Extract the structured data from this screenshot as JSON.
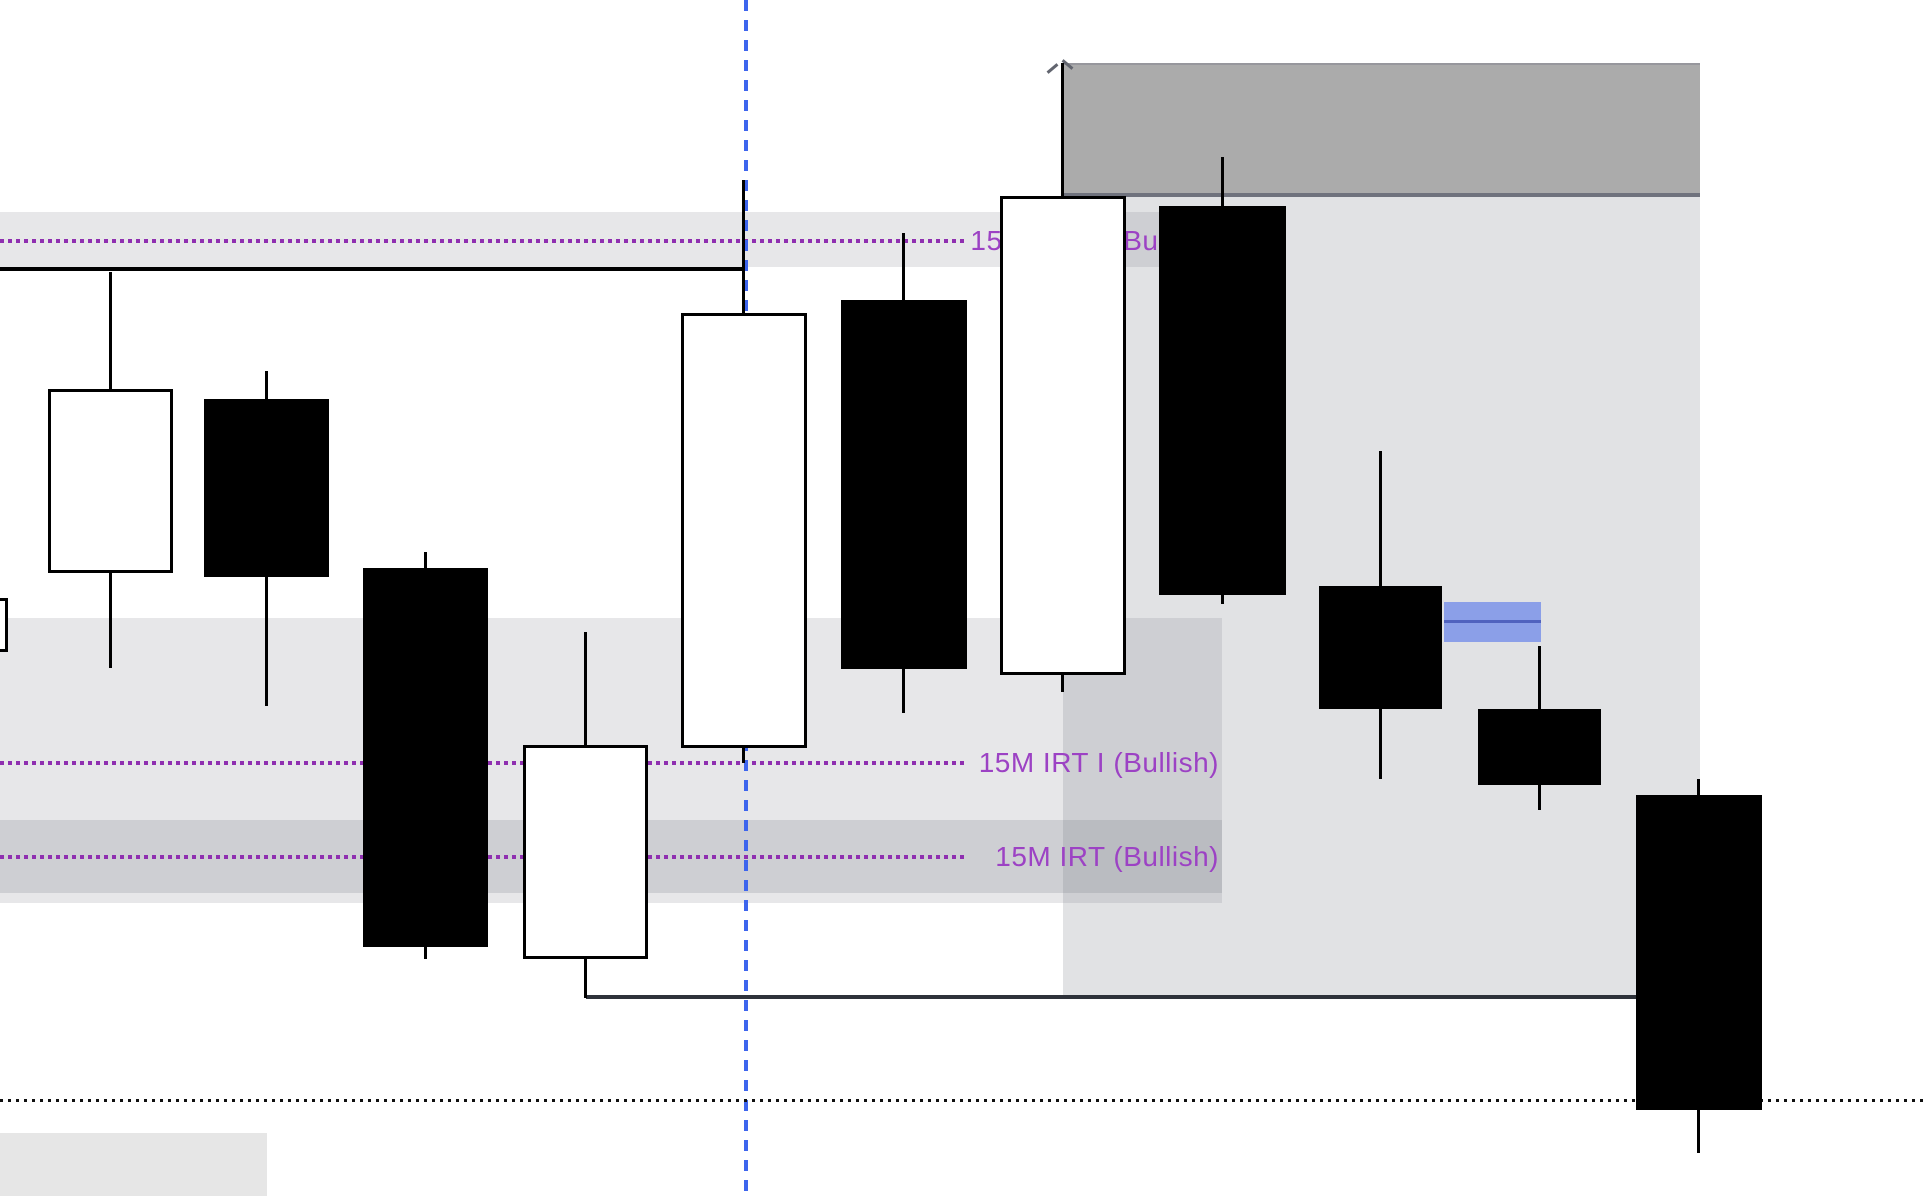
{
  "app": {
    "description": "Zoomed candlestick trading chart with IRT (Bullish) indicator levels, supply/demand zones and drawing objects"
  },
  "labels": {
    "top": {
      "text": "15M IRT II (Bullish)"
    },
    "middle": {
      "text": "15M IRT I (Bullish)"
    },
    "bottom": {
      "text": "15M IRT (Bullish)"
    }
  },
  "colors": {
    "background": "#FFFFFF",
    "purple_text": "#9C42C4",
    "purple_dots": "#8F2FB0",
    "blue_dash": "#3D65ED",
    "badge_fill": "#8B9FE8",
    "badge_line": "#5062BE",
    "band_fill": "rgba(120,123,134,0.18)",
    "sub_band_fill": "rgba(120,123,134,0.22)",
    "zone_fill": "rgba(120,123,134,0.22)",
    "header_fill": "#ABABAB",
    "header_border_bottom": "#6F727D",
    "header_border_top": "#97979D",
    "candle_up_fill": "#FFFFFF",
    "candle_down_fill": "#000000",
    "candle_border": "#000000",
    "low_line": "#2E323A",
    "black_line": "#000000",
    "bottom_dots": "#101010",
    "handle": "#62656F",
    "bottom_left_box": "#E6E6E6"
  },
  "chart_data": {
    "type": "candlestick",
    "axes_visible": false,
    "units": "screen pixels, y increases downward; no price/time tick labels are visible in the screenshot",
    "candles": [
      {
        "i": 0,
        "x": -14,
        "w": 22,
        "high": 598,
        "body_top": 598,
        "body_bottom": 652,
        "low": 652,
        "dir": "up",
        "partial": true
      },
      {
        "i": 1,
        "x": 48,
        "w": 125,
        "high": 272,
        "body_top": 389,
        "body_bottom": 573,
        "low": 668,
        "dir": "up"
      },
      {
        "i": 2,
        "x": 204,
        "w": 125,
        "high": 371,
        "body_top": 399,
        "body_bottom": 577,
        "low": 706,
        "dir": "down"
      },
      {
        "i": 3,
        "x": 363,
        "w": 125,
        "high": 552,
        "body_top": 568,
        "body_bottom": 947,
        "low": 959,
        "dir": "down"
      },
      {
        "i": 4,
        "x": 523,
        "w": 125,
        "high": 632,
        "body_top": 745,
        "body_bottom": 959,
        "low": 998,
        "dir": "up"
      },
      {
        "i": 5,
        "x": 681,
        "w": 126,
        "high": 180,
        "body_top": 313,
        "body_bottom": 748,
        "low": 763,
        "dir": "up"
      },
      {
        "i": 6,
        "x": 841,
        "w": 126,
        "high": 233,
        "body_top": 300,
        "body_bottom": 669,
        "low": 713,
        "dir": "down"
      },
      {
        "i": 7,
        "x": 1000,
        "w": 126,
        "high": 63,
        "body_top": 196,
        "body_bottom": 675,
        "low": 692,
        "dir": "up"
      },
      {
        "i": 8,
        "x": 1159,
        "w": 127,
        "high": 157,
        "body_top": 206,
        "body_bottom": 595,
        "low": 604,
        "dir": "down"
      },
      {
        "i": 9,
        "x": 1319,
        "w": 123,
        "high": 451,
        "body_top": 586,
        "body_bottom": 709,
        "low": 779,
        "dir": "down"
      },
      {
        "i": 10,
        "x": 1478,
        "w": 123,
        "high": 646,
        "body_top": 709,
        "body_bottom": 785,
        "low": 810,
        "dir": "down"
      },
      {
        "i": 11,
        "x": 1636,
        "w": 126,
        "high": 779,
        "body_top": 795,
        "body_bottom": 1110,
        "low": 1153,
        "dir": "down"
      }
    ],
    "annotations": {
      "purple_dotted_levels": [
        {
          "y": 241,
          "x_end": 965,
          "label": "15M IRT II (Bullish)"
        },
        {
          "y": 763,
          "x_end": 965,
          "label": "15M IRT I (Bullish)"
        },
        {
          "y": 857,
          "x_end": 965,
          "label": "15M IRT (Bullish)"
        }
      ],
      "bands": [
        {
          "name": "irt-ii-band",
          "x": 0,
          "y": 212,
          "w": 1222,
          "h": 55,
          "shade": "light"
        },
        {
          "name": "irt-i-band",
          "x": 0,
          "y": 618,
          "w": 1222,
          "h": 285,
          "shade": "light"
        },
        {
          "name": "irt-band",
          "x": 0,
          "y": 820,
          "w": 1222,
          "h": 73,
          "shade": "dark"
        }
      ],
      "zones": [
        {
          "name": "supply-header-box",
          "x": 1063,
          "y": 63,
          "w": 637,
          "h": 134,
          "style": "solid-gray"
        },
        {
          "name": "right-demand-zone",
          "x": 1063,
          "y": 196,
          "w": 637,
          "h": 801,
          "style": "translucent"
        },
        {
          "name": "bottom-left-box",
          "x": 0,
          "y": 1133,
          "w": 267,
          "h": 63,
          "style": "solid-light"
        }
      ],
      "black_lines": [
        {
          "name": "upper-structure-line",
          "x1": 0,
          "x2": 745,
          "y": 267,
          "h": 4,
          "style": "solid"
        },
        {
          "name": "low-structure-line",
          "x1": 586,
          "x2": 1690,
          "y": 995,
          "h": 4,
          "style": "solid"
        },
        {
          "name": "bottom-dotted-line",
          "x1": 0,
          "x2": 1924,
          "y": 1099,
          "h": 3,
          "style": "dotted"
        }
      ],
      "vertical_dashed_line": {
        "x": 744,
        "w": 4,
        "y1": 0,
        "y2": 1196
      },
      "order_block_badge": {
        "x": 1444,
        "y": 602,
        "w": 97,
        "h": 40,
        "mid_line_y": 620
      },
      "handle_marks": [
        {
          "x": 1046,
          "y": 67,
          "angle": -40
        },
        {
          "x": 1061,
          "y": 63,
          "angle": 40
        }
      ]
    }
  }
}
